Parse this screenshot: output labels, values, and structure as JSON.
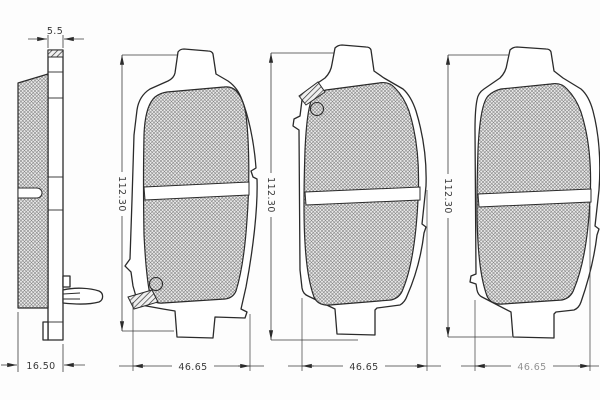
{
  "drawing": {
    "description": "brake-pad technical drawing, four views",
    "colors": {
      "line": "#2b2b2b",
      "background": "#ffffff",
      "hatch": "#808080"
    },
    "views": {
      "side": {
        "top_dim": "5.5",
        "bottom_dim": "16.50"
      },
      "front1": {
        "height_dim": "112.30",
        "width_dim": "46.65"
      },
      "front2": {
        "height_dim": "112.30",
        "width_dim": "46.65"
      },
      "front3": {
        "height_dim": "112.30",
        "width_dim": "46.65"
      }
    }
  }
}
